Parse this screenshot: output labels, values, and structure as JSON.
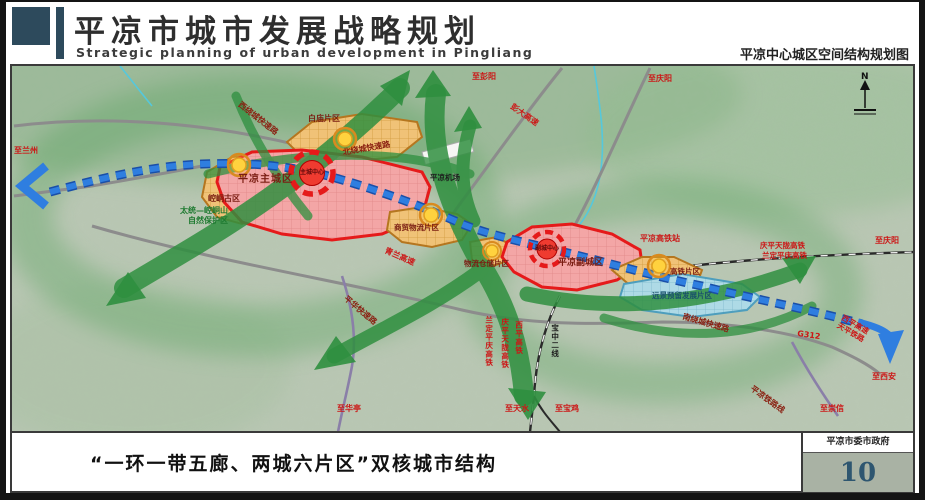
{
  "header": {
    "title": "平凉市城市发展战略规划",
    "subtitle": "Strategic planning of urban development in Pingliang",
    "right_caption": "平凉中心城区空间结构规划图"
  },
  "footer": {
    "caption": "“一环一带五廊、两城六片区”双核城市结构",
    "agency": "平凉市委市政府",
    "page_number": "10"
  },
  "map": {
    "compass": "N",
    "labels": {
      "zhi_lanzhou": "至兰州",
      "zhi_pengyang": "至彭阳",
      "zhi_qingyang_top": "至庆阳",
      "zhi_qingyang_right": "至庆阳",
      "qingping_tianlong_hsr": "庆平天陇高铁",
      "landing_pingqing_hsr": "兰定平庆高铁",
      "pengda_expwy": "彭大高速",
      "north_ring_road": "北绕城快速路",
      "west_ring_road": "西绕城快速路",
      "qinglan_expwy": "青兰高速",
      "south_ring_road": "南绕城快速路",
      "pinghua_expwy": "平华快速路",
      "pingliang_railway": "平凉铁路线",
      "g312": "G312",
      "xiping_expwy": "西平高速",
      "tianping_railway": "天平铁路",
      "zhi_xian": "至西安",
      "zhi_chongxin": "至崇信",
      "zhi_huating": "至华亭",
      "zhi_tianshui": "至天水",
      "zhi_baoji": "至宝鸡",
      "baozhong_line2": "宝中二线",
      "xiping_hsr_v": "西平高铁",
      "qingping_tianlong_v": "庆平天陇高铁",
      "landing_pingqing_v": "兰定平庆高铁",
      "nature_reserve_1": "太统—崆峒山",
      "nature_reserve_2": "自然保护区",
      "main_city": "平凉主城区",
      "main_center": "主城中心",
      "east_city": "平凉副城区",
      "east_center": "副城中心",
      "baimiao_district": "白庙片区",
      "kongtong_district": "崆峒古区",
      "trade_logistics_district": "商贸物流片区",
      "warehouse_district": "物流仓储片区",
      "hsr_district": "高铁片区",
      "reserve_district": "远景预留发展片区",
      "hsr_station": "平凉高铁站",
      "airport": "平凉机场"
    }
  },
  "colors": {
    "brand_dark_blue": "#2d4a5c",
    "corridor_green": "#2f8f3f",
    "axis_blue": "#2f7ee0",
    "main_city_red": "#e51a1a",
    "district_orange": "#f0c277",
    "reserve_blue": "#aedae6",
    "page_number_bg": "#a9b2a4"
  }
}
